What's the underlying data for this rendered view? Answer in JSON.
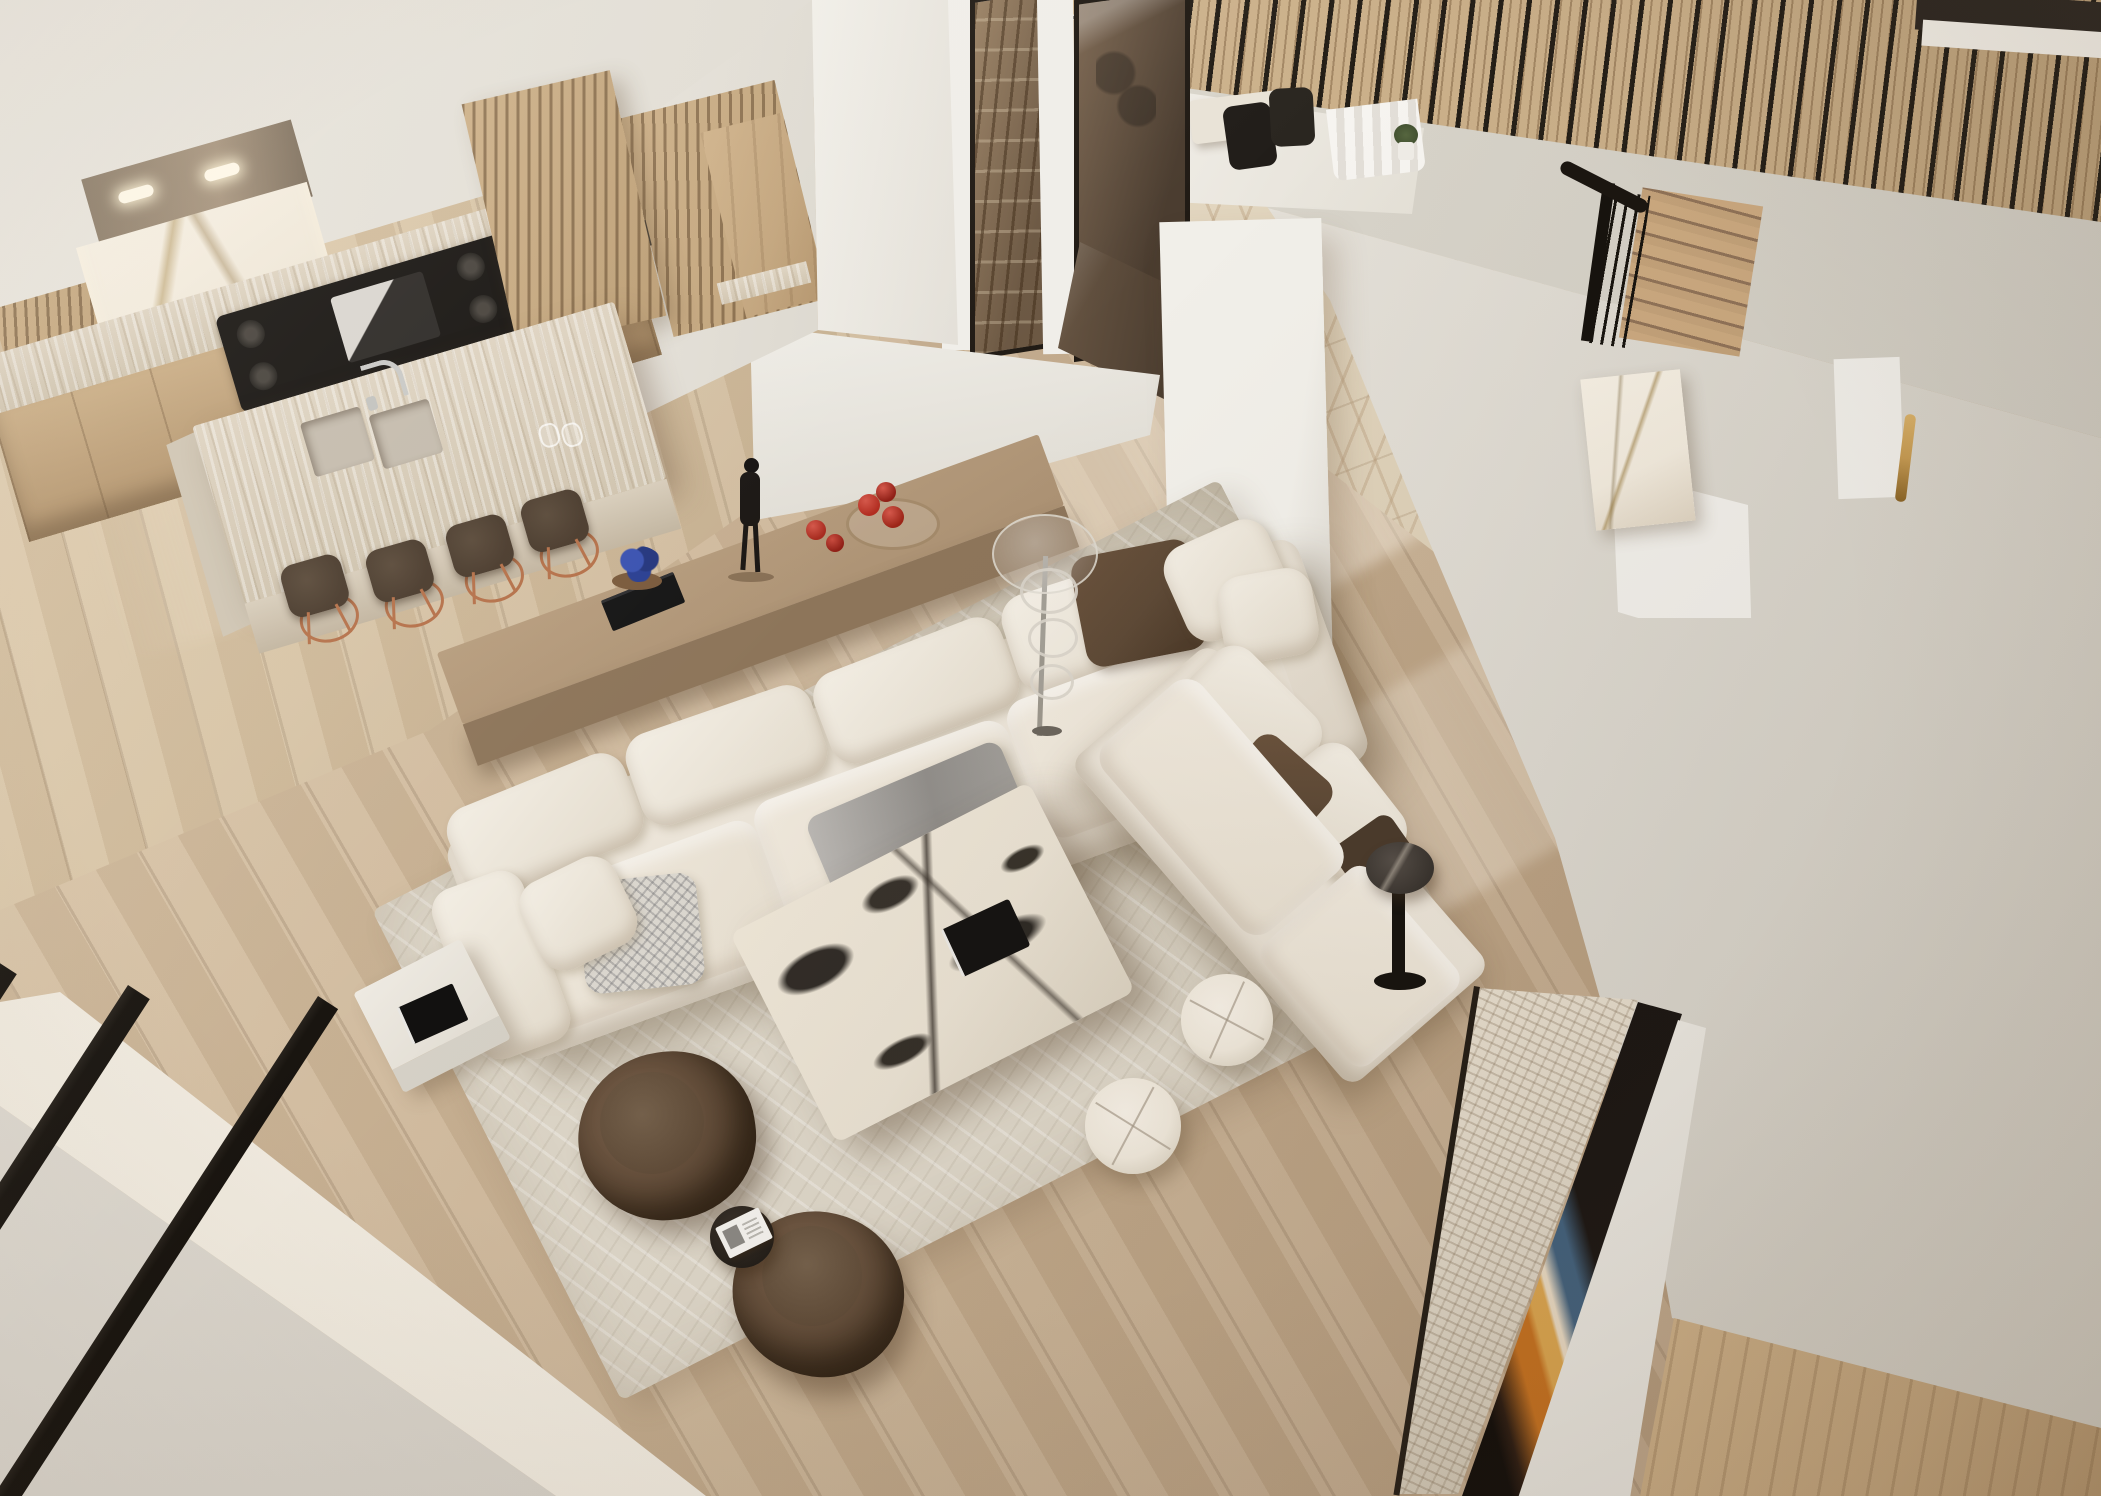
{
  "scene": {
    "label": "Photorealistic aerial rendering of a double-height open-plan interior: cream sectional sofas on an abstract rug, marble coffee table, kitchen with travertine waterfall island and copper bar stools, bronze-glass wine room, chevron parquet hall, oak staircase and mezzanine with black balustrade rods",
    "view": "top-down from mezzanine balcony",
    "rooms": [
      "living room",
      "kitchen",
      "wine room",
      "dining nook",
      "entry hall",
      "staircase",
      "mezzanine walkway"
    ]
  },
  "objects": {
    "living_room": [
      "cream modular sofa",
      "cream chaise daybed",
      "taupe console table",
      "black figurine sculpture",
      "red apples in glass dish",
      "blue flowers on black books",
      "tall glass floor lamp",
      "black-and-white veined marble coffee table",
      "black coffee-table book",
      "gray throw blanket with fringe",
      "patterned gray pillow",
      "brown accent pillows",
      "abstract cream area rug",
      "two white round poufs",
      "two brown barrel swivel chairs",
      "black round side table with magazine",
      "white side table with black book",
      "dark marble round side table"
    ],
    "kitchen": [
      "white-gold marble backsplash",
      "black gas range cooktop",
      "travertine perimeter counter",
      "oak cabinet fronts",
      "travertine waterfall island",
      "double undermount sink",
      "chrome arc faucet",
      "four bar stools with dark seats and copper frames",
      "white-oak slatted tall cabinet",
      "oak entry cabinet"
    ],
    "architecture": [
      "double-height void",
      "wood-slat ceiling band",
      "black metal balustrade rods",
      "bronze-glass wine room with black frames",
      "chevron parquet hall floor",
      "wide-plank oak flooring",
      "white structural pillars",
      "oak staircase with black spindle railing",
      "calacatta marble bar at stair base",
      "travertine fireplace band",
      "abstract orange-blue wall artwork",
      "brass door pull",
      "white sheer curtains",
      "potted plant",
      "black dining chairs",
      "foreground balcony railing bars"
    ]
  },
  "palette": {
    "floor-base": "#c9b294",
    "floor-light": "#dbc6a8",
    "floor-shadow": "#b49a7c",
    "floor-kitchen": "#d4bf9f",
    "chevron-base": "#e4d8c2",
    "wall-light": "#e9e5dd",
    "wall-mid": "#dcd8cf",
    "wall-dark": "#cfcabf",
    "pillar-white": "#f0eee9",
    "fascia": "#d9d5cb",
    "slat-wood": "#c9ae88",
    "rod-black": "#17130e",
    "glass-dark": "#4a3c2f",
    "glass-mid": "#7a6550",
    "frame-black": "#201a14",
    "travertine": "#ded3c1",
    "cabinet-wood": "#c2a47c",
    "cooktop-black": "#15120f",
    "stool-seat": "#4a3b2d",
    "stool-copper": "#b5714a",
    "sofa-cream": "#e9e2d6",
    "cushion-white": "#f3eee4",
    "pillow-brown": "#5d4936",
    "throw-gray": "#a3a09b",
    "console-wood": "#ab9173",
    "rug-base": "#dcd5c7",
    "rug-shade": "#c7bfae",
    "ctable-marble": "#e7dfd0",
    "ctable-vein": "#1d1915",
    "chair-brown": "#53402e",
    "chair-brown-dark": "#3a2c1d",
    "pouf-cream": "#eee7da",
    "stairs-wood": "#c2a179",
    "marble-bar": "#f0e9dc",
    "trav-band": "#ddd4c4",
    "art-dark": "#161110",
    "art-orange": "#c4701f",
    "art-amber": "#daa44e",
    "art-blue": "#41607c",
    "accent-red": "#b12c20",
    "accent-blue": "#2a3f92",
    "brass": "#c59a52",
    "ledge-white": "#efe9de",
    "corner-wall": "#d7d2c9"
  }
}
